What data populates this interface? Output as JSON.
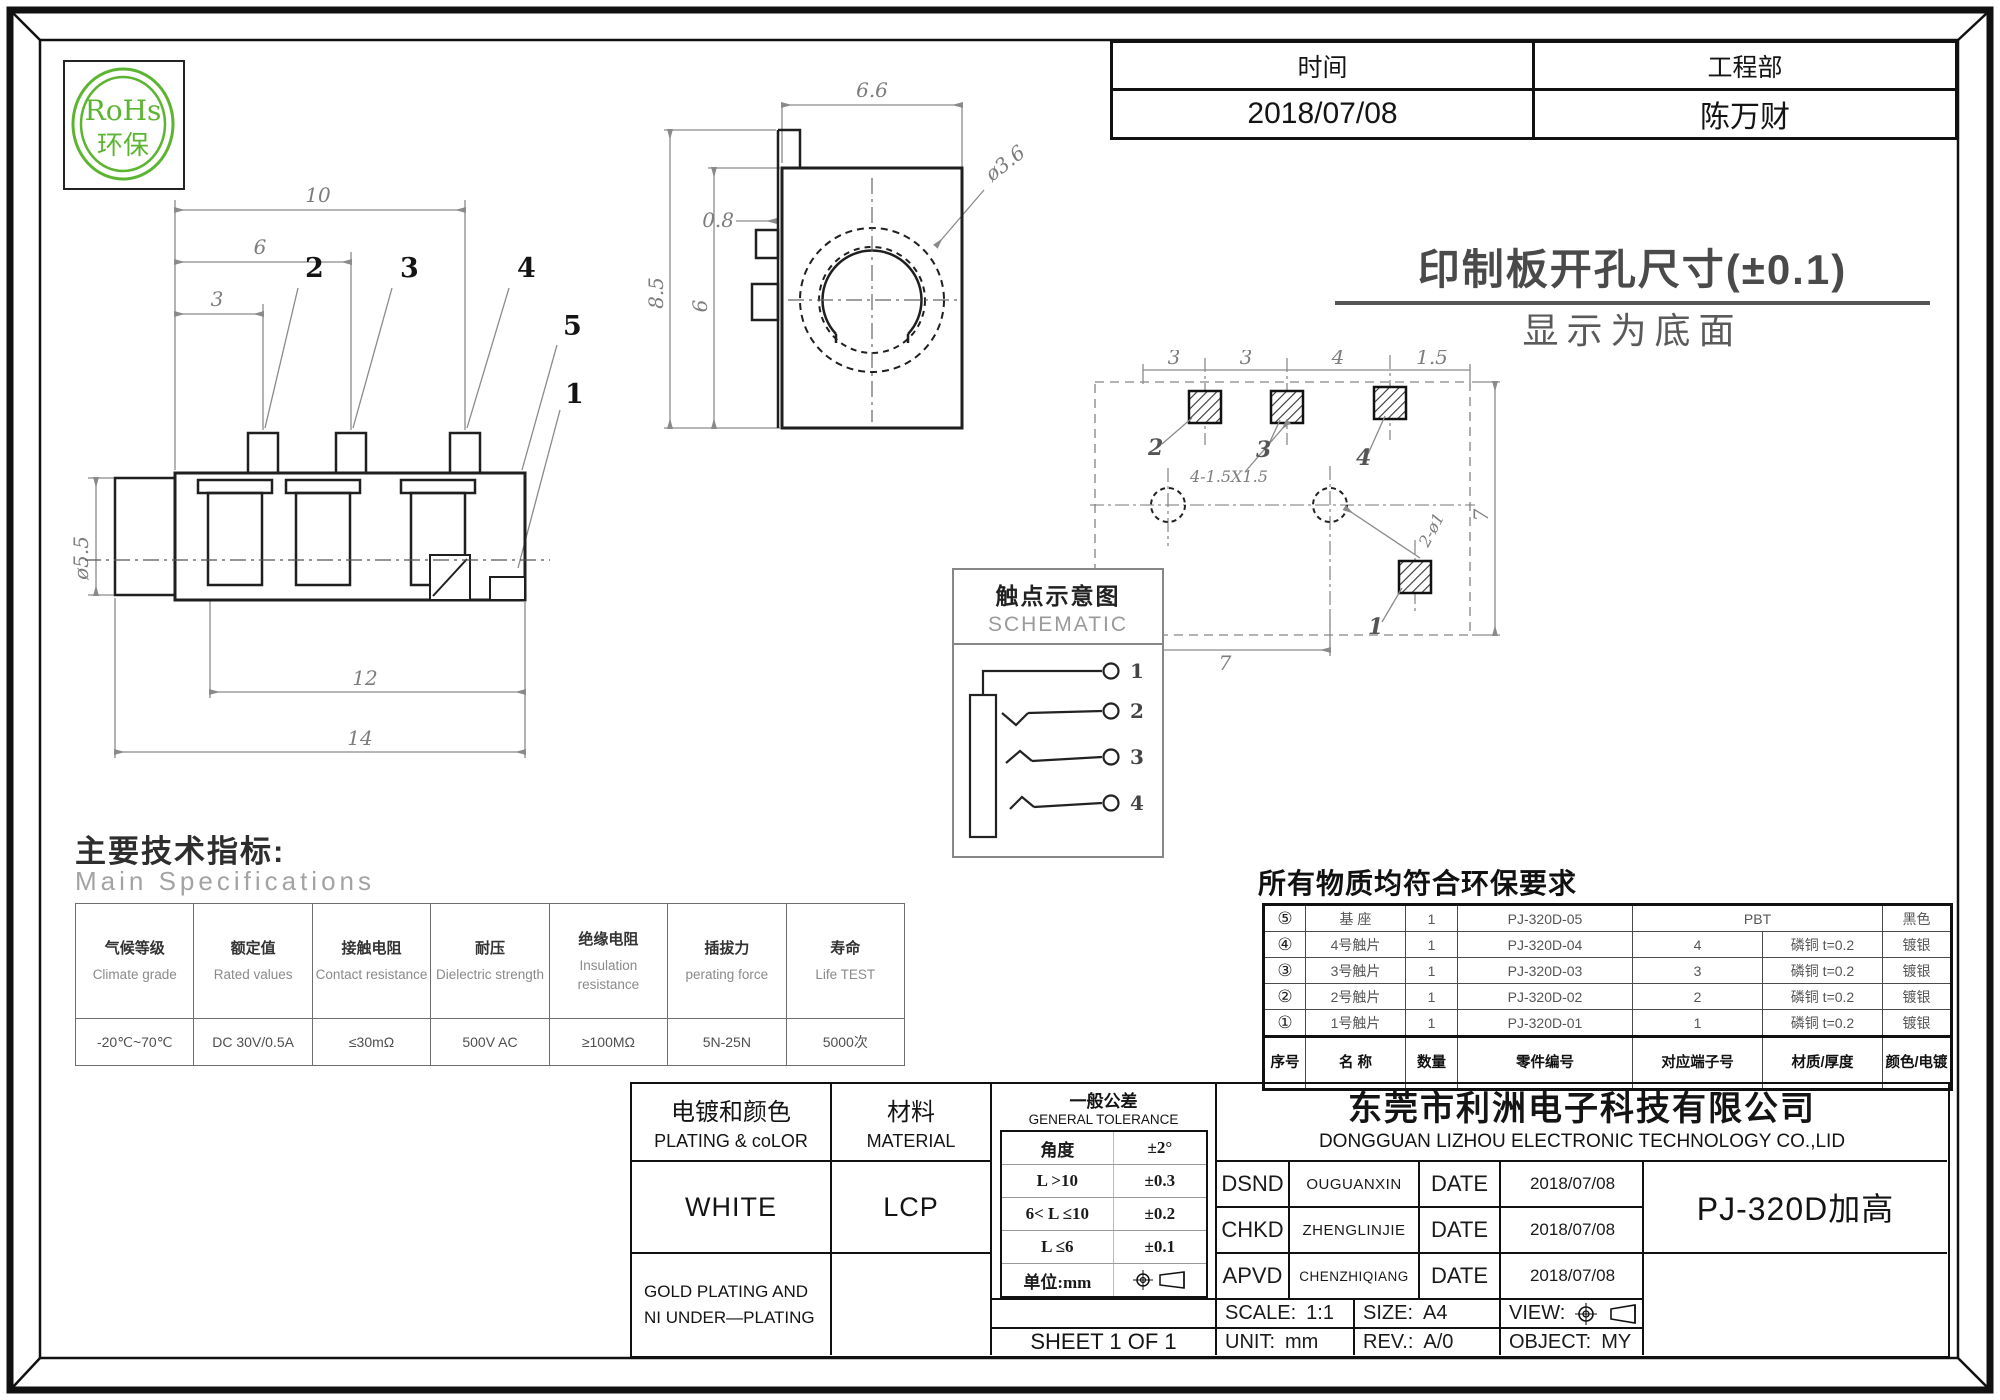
{
  "colors": {
    "rohs_green": "#5cb531",
    "frame": "#141414",
    "dim_gray": "#8a8a8a"
  },
  "logo": {
    "line1": "RoHs",
    "line2": "环保"
  },
  "info_table": {
    "time_label": "时间",
    "dept_label": "工程部",
    "time_value": "2018/07/08",
    "dept_value": "陈万财"
  },
  "side_view": {
    "dims": {
      "d10": "10",
      "d6": "6",
      "d3": "3",
      "dia": "ø5.5",
      "d12": "12",
      "d14": "14"
    },
    "pins": {
      "p1": "1",
      "p2": "2",
      "p3": "3",
      "p4": "4",
      "p5": "5"
    }
  },
  "front_view": {
    "dims": {
      "w": "6.6",
      "t": "0.8",
      "h": "8.5",
      "h2": "6",
      "dia": "ø3.6"
    }
  },
  "pcb_view": {
    "title1": "印制板开孔尺寸(±0.1)",
    "title2": "显示为底面",
    "dims": {
      "a": "3",
      "b": "3",
      "c": "4",
      "d": "1.5",
      "right": "7",
      "e": "1.5",
      "f": "7",
      "pads": "4-1.5X1.5",
      "holes": "2-ø1"
    },
    "labels": {
      "p1": "1",
      "p2": "2",
      "p3": "3",
      "p4": "4"
    }
  },
  "schematic": {
    "title_cn": "触点示意图",
    "title_en": "SCHEMATIC",
    "contacts": [
      "1",
      "2",
      "3",
      "4"
    ]
  },
  "specs": {
    "heading_cn": "主要技术指标:",
    "heading_en": "Main Specifications",
    "columns": [
      {
        "cn": "气候等级",
        "en": "Climate grade",
        "value": "-20℃~70℃"
      },
      {
        "cn": "额定值",
        "en": "Rated values",
        "value": "DC 30V/0.5A"
      },
      {
        "cn": "接触电阻",
        "en": "Contact resistance",
        "value": "≤30mΩ"
      },
      {
        "cn": "耐压",
        "en": "Dielectric strength",
        "value": "500V AC"
      },
      {
        "cn": "绝缘电阻",
        "en": "Insulation resistance",
        "value": "≥100MΩ"
      },
      {
        "cn": "插拔力",
        "en": "perating force",
        "value": "5N-25N"
      },
      {
        "cn": "寿命",
        "en": "Life TEST",
        "value": "5000次"
      }
    ]
  },
  "bom": {
    "title": "所有物质均符合环保要求",
    "headers": {
      "no": "序号",
      "name": "名 称",
      "qty": "数量",
      "part": "零件编号",
      "terminal": "对应端子号",
      "material": "材质/厚度",
      "finish": "颜色/电镀"
    },
    "rows": [
      {
        "no": "⑤",
        "name": "基 座",
        "qty": "1",
        "part": "PJ-320D-05",
        "terminal": "",
        "material": "PBT",
        "finish": "黑色"
      },
      {
        "no": "④",
        "name": "4号触片",
        "qty": "1",
        "part": "PJ-320D-04",
        "terminal": "4",
        "material": "磷铜  t=0.2",
        "finish": "镀银"
      },
      {
        "no": "③",
        "name": "3号触片",
        "qty": "1",
        "part": "PJ-320D-03",
        "terminal": "3",
        "material": "磷铜  t=0.2",
        "finish": "镀银"
      },
      {
        "no": "②",
        "name": "2号触片",
        "qty": "1",
        "part": "PJ-320D-02",
        "terminal": "2",
        "material": "磷铜  t=0.2",
        "finish": "镀银"
      },
      {
        "no": "①",
        "name": "1号触片",
        "qty": "1",
        "part": "PJ-320D-01",
        "terminal": "1",
        "material": "磷铜  t=0.2",
        "finish": "镀银"
      }
    ]
  },
  "titleblock": {
    "plating_cn": "电镀和颜色",
    "plating_en": "PLATING & coLOR",
    "plating_value": "WHITE",
    "plating_note1": "GOLD PLATING AND",
    "plating_note2": "NI UNDER—PLATING",
    "material_cn": "材料",
    "material_en": "MATERIAL",
    "material_value": "LCP",
    "tol_cn": "一般公差",
    "tol_en": "GENERAL TOLERANCE",
    "tol_rows": [
      {
        "range": "角度",
        "tol": "±2°"
      },
      {
        "range": "L >10",
        "tol": "±0.3"
      },
      {
        "range": "6< L ≤10",
        "tol": "±0.2"
      },
      {
        "range": "L ≤6",
        "tol": "±0.1"
      }
    ],
    "unit_row_label": "单位:mm",
    "sheet": "SHEET 1 OF 1",
    "company_cn": "东莞市利洲电子科技有限公司",
    "company_en": "DONGGUAN LIZHOU ELECTRONIC TECHNOLOGY CO.,LID",
    "sign_rows": [
      {
        "role": "DSND",
        "name": "OUGUANXIN",
        "date_label": "DATE",
        "date": "2018/07/08"
      },
      {
        "role": "CHKD",
        "name": "ZHENGLINJIE",
        "date_label": "DATE",
        "date": "2018/07/08"
      },
      {
        "role": "APVD",
        "name": "CHENZHIQIANG",
        "date_label": "DATE",
        "date": "2018/07/08"
      }
    ],
    "part_name": "PJ-320D加高",
    "scale_label": "SCALE:",
    "scale_value": "1:1",
    "size_label": "SIZE:",
    "size_value": "A4",
    "view_label": "VIEW:",
    "unit_label": "UNIT:",
    "unit_value": "mm",
    "rev_label": "REV.:",
    "rev_value": "A/0",
    "object_label": "OBJECT:",
    "object_value": "MY"
  }
}
